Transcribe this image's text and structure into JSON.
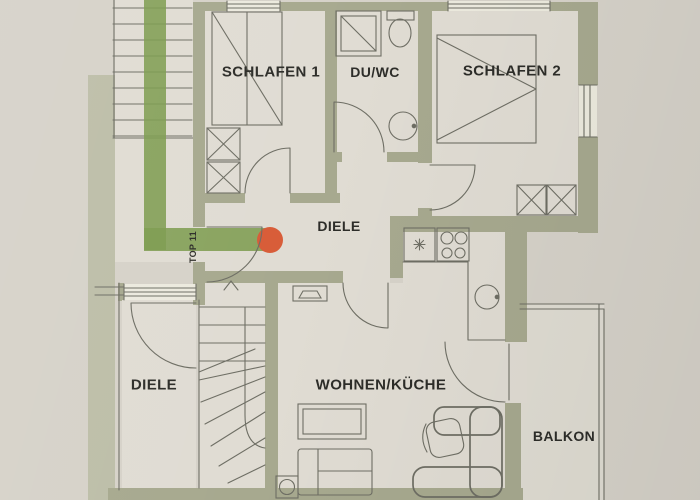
{
  "plan": {
    "rooms": {
      "schlafen1": "SCHLAFEN 1",
      "duwc": "DU/WC",
      "schlafen2": "SCHLAFEN 2",
      "diele_upper": "DIELE",
      "diele_lower": "DIELE",
      "wohnen_kueche": "WOHNEN/KÜCHE",
      "balkon": "BALKON"
    },
    "unit_label": "TOP 11"
  },
  "colors": {
    "background": "#d6d2c9",
    "floor": "#e0dcd3",
    "wall": "#a7a98f",
    "sage": "#bdbea8",
    "route": "#7d9c50",
    "marker": "#d85c38",
    "ink": "#6e6e64",
    "text": "#2d2d29"
  }
}
